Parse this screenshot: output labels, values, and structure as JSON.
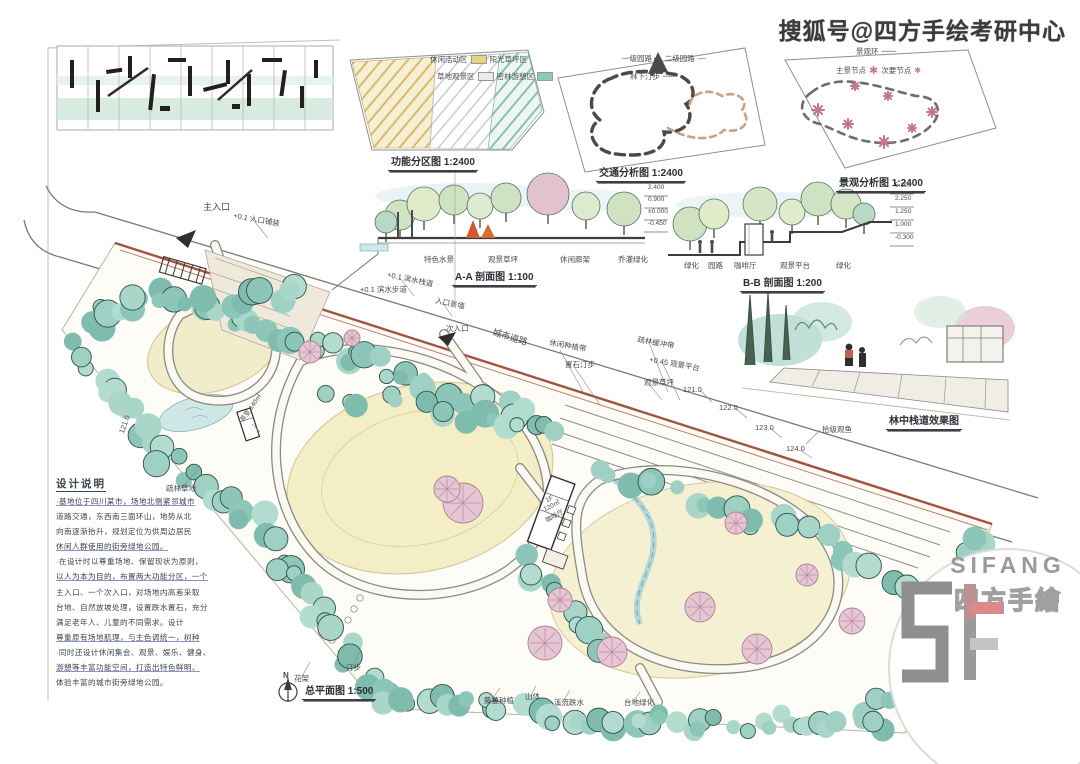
{
  "watermark": "搜狐号@四方手绘考研中心",
  "diagrams": {
    "zoning": {
      "caption": "功能分区图 1:2400"
    },
    "traffic": {
      "caption": "交通分析图 1:2400"
    },
    "landscape": {
      "caption": "景观分析图 1:2400"
    }
  },
  "legends": {
    "zoning": {
      "rows": [
        [
          {
            "t": "休闲活动区"
          },
          {
            "sw": "#e6d27f"
          },
          {
            "t": "阳光草坪区"
          }
        ],
        [
          {
            "t": "草地观景区"
          },
          {
            "sw": "#e6eee4"
          },
          {
            "t": "密林游憩区"
          },
          {
            "sw": "#8fc7b9"
          }
        ]
      ]
    },
    "traffic": {
      "rows": [
        [
          {
            "t": "一级园路"
          },
          {
            "ic": "➡",
            "name": "arrow-icon"
          },
          {
            "t": "二级园路"
          },
          {
            "ic": "—",
            "name": "solid-line-icon"
          }
        ],
        [
          {
            "t": "林下汀步"
          },
          {
            "ic": "╌╌╌",
            "name": "dashed-line-icon"
          }
        ]
      ]
    },
    "landscape": {
      "rows": [
        [
          {
            "t": "景观环"
          },
          {
            "ic": "╌╌╌",
            "name": "dashed-line-icon"
          }
        ],
        [
          {
            "t": "主景节点"
          },
          {
            "ic": "✱",
            "cls": "star",
            "name": "major-node-icon"
          },
          {
            "t": "次要节点"
          },
          {
            "ic": "✱",
            "cls": "star sm",
            "name": "minor-node-icon"
          }
        ]
      ]
    }
  },
  "sections": {
    "aa": {
      "caption": "A-A 剖面图 1:100",
      "labels": [
        {
          "t": "特色水景",
          "x": 424,
          "y": 256
        },
        {
          "t": "观景草坪",
          "x": 488,
          "y": 256
        },
        {
          "t": "休闲廊架",
          "x": 560,
          "y": 256
        },
        {
          "t": "乔灌绿化",
          "x": 618,
          "y": 256
        },
        {
          "t": "+0.1 滨水步道",
          "x": 360,
          "y": 286
        }
      ]
    },
    "bb": {
      "caption": "B-B 剖面图 1:200",
      "labels": [
        {
          "t": "绿化",
          "x": 684,
          "y": 262
        },
        {
          "t": "园路",
          "x": 708,
          "y": 262
        },
        {
          "t": "咖啡厅",
          "x": 734,
          "y": 262
        },
        {
          "t": "观景平台",
          "x": 780,
          "y": 262
        },
        {
          "t": "绿化",
          "x": 836,
          "y": 262
        }
      ]
    },
    "stacks": [
      {
        "x": 648,
        "y0": 192,
        "dy": 12,
        "vals": [
          "2.400",
          "0.900",
          "±0.000",
          "-0.450"
        ]
      },
      {
        "x": 895,
        "y0": 190,
        "dy": 13,
        "vals": [
          "5.100",
          "2.250",
          "1.250",
          "1.000",
          "-0.300"
        ]
      }
    ]
  },
  "perspective": {
    "caption": "林中栈道效果图"
  },
  "plan": {
    "caption": "总平面图 1:500",
    "north_label": "N",
    "labels": [
      {
        "t": "主入口",
        "x": 203,
        "y": 203,
        "r": 0,
        "s": 9
      },
      {
        "t": "+0.1 入口铺装",
        "x": 234,
        "y": 212,
        "r": 10,
        "s": 7.5
      },
      {
        "t": "+0.1 滨水栈道",
        "x": 388,
        "y": 271,
        "r": 12,
        "s": 7.5
      },
      {
        "t": "入口景墙",
        "x": 436,
        "y": 297,
        "r": 12,
        "s": 7.5
      },
      {
        "t": "次入口",
        "x": 446,
        "y": 325,
        "r": 0,
        "s": 7.5
      },
      {
        "t": "城市道路",
        "x": 494,
        "y": 328,
        "r": 17,
        "s": 9
      },
      {
        "t": "休闲种植带",
        "x": 550,
        "y": 339,
        "r": 10,
        "s": 7.5
      },
      {
        "t": "置石汀步",
        "x": 565,
        "y": 361,
        "r": 0,
        "s": 7.5
      },
      {
        "t": "疏林缓冲带",
        "x": 638,
        "y": 336,
        "r": 10,
        "s": 7.5
      },
      {
        "t": "+0.45 观景平台",
        "x": 650,
        "y": 356,
        "r": 10,
        "s": 7.5
      },
      {
        "t": "观景草坪",
        "x": 644,
        "y": 379,
        "r": 0,
        "s": 7.5
      },
      {
        "t": "121.0",
        "x": 683,
        "y": 386,
        "r": 0,
        "s": 7.5
      },
      {
        "t": "122.0",
        "x": 719,
        "y": 404,
        "r": 0,
        "s": 7.5
      },
      {
        "t": "123.0",
        "x": 755,
        "y": 424,
        "r": 0,
        "s": 7.5
      },
      {
        "t": "124.0",
        "x": 786,
        "y": 445,
        "r": 0,
        "s": 7.5
      },
      {
        "t": "拾级观鱼",
        "x": 822,
        "y": 426,
        "r": 0,
        "s": 7.5
      },
      {
        "t": "121.0",
        "x": 118,
        "y": 432,
        "r": -70,
        "s": 7.5
      },
      {
        "t": "疏林草地",
        "x": 166,
        "y": 485,
        "r": 0,
        "s": 7.5
      },
      {
        "t": "茶室 140㎡",
        "x": 240,
        "y": 420,
        "r": -55,
        "s": 6.5
      },
      {
        "t": "花架",
        "x": 294,
        "y": 675,
        "r": 0,
        "s": 7.5
      },
      {
        "t": "汀步",
        "x": 346,
        "y": 664,
        "r": 0,
        "s": 7.5
      },
      {
        "t": "藤蔓种植",
        "x": 484,
        "y": 697,
        "r": 0,
        "s": 7.5
      },
      {
        "t": "山体",
        "x": 525,
        "y": 693,
        "r": 0,
        "s": 7.5
      },
      {
        "t": "溪流跌水",
        "x": 554,
        "y": 699,
        "r": 0,
        "s": 7.5
      },
      {
        "t": "台地绿化",
        "x": 624,
        "y": 699,
        "r": 0,
        "s": 7.5
      },
      {
        "t": "1F",
        "x": 545,
        "y": 499,
        "r": -28,
        "s": 6.5
      },
      {
        "t": "120㎡",
        "x": 543,
        "y": 508,
        "r": -28,
        "s": 6.5
      },
      {
        "t": "咖啡厅",
        "x": 545,
        "y": 519,
        "r": -28,
        "s": 6.5
      }
    ]
  },
  "notes": {
    "title": "设计说明",
    "lines": [
      {
        "t": "·基地位于四川某市，场地北侧紧邻城市",
        "u": true
      },
      {
        "t": "道路交通，东西南三面环山，地势从北",
        "u": false
      },
      {
        "t": "向南逐渐抬升，规划定位为供周边居民",
        "u": false
      },
      {
        "t": "休闲人群使用的街旁绿地公园。",
        "u": true
      },
      {
        "t": "·在设计时以尊重场地、保留现状为原则，",
        "u": false
      },
      {
        "t": "以人为本为目的，布置两大功能分区，一个",
        "u": true
      },
      {
        "t": "主入口、一个次入口，对场地内高差采取",
        "u": false
      },
      {
        "t": "台地、自然放坡处理，设置跌水置石，充分",
        "u": false
      },
      {
        "t": "满足老年人、儿童的不同需求。设计",
        "u": false
      },
      {
        "t": "尊重原有场地肌理，与主色调统一，树种",
        "u": true
      },
      {
        "t": "·同时还设计休闲集会、观景、娱乐、健身、",
        "u": false
      },
      {
        "t": "游憩等丰富功能空间，打造出特色鲜明、",
        "u": true
      },
      {
        "t": "体验丰富的城市街旁绿地公园。",
        "u": false
      }
    ]
  },
  "captions": [
    {
      "t": "功能分区图 1:2400",
      "x": 388,
      "y": 153,
      "s": 10
    },
    {
      "t": "交通分析图 1:2400",
      "x": 596,
      "y": 164,
      "s": 10
    },
    {
      "t": "景观分析图 1:2400",
      "x": 836,
      "y": 174,
      "s": 10
    },
    {
      "t": "A-A 剖面图 1:100",
      "x": 452,
      "y": 268,
      "s": 10
    },
    {
      "t": "B-B 剖面图 1:200",
      "x": 740,
      "y": 274,
      "s": 10
    },
    {
      "t": "林中栈道效果图",
      "x": 886,
      "y": 412,
      "s": 10
    },
    {
      "t": "总平面图 1:500",
      "x": 302,
      "y": 682,
      "s": 10
    }
  ],
  "logo": {
    "name": "SIFANG",
    "cn": "四方手繪"
  }
}
